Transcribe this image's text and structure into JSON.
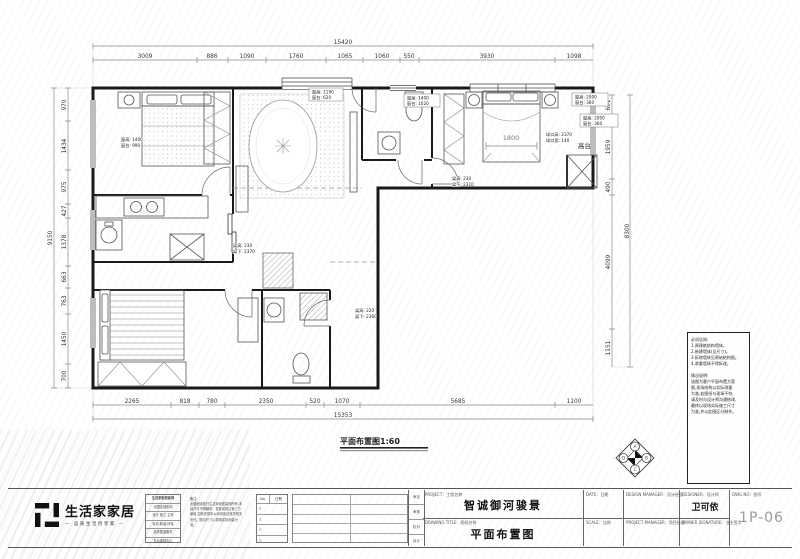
{
  "dims": {
    "top": {
      "overall": "15420",
      "segments": [
        "3009",
        "886",
        "1090",
        "1760",
        "1065",
        "1060",
        "550",
        "3930",
        "1098"
      ]
    },
    "left": {
      "overall": "9150",
      "segments": [
        "970",
        "1434",
        "975",
        "427",
        "1378",
        "663",
        "763",
        "1450",
        "700"
      ]
    },
    "right": {
      "overall": "8300",
      "segments": [
        "601",
        "1959",
        "490",
        "4099",
        "1151"
      ]
    },
    "bottom": {
      "overall": "15353",
      "segments": [
        "2265",
        "818",
        "780",
        "2350",
        "520",
        "1070",
        "5685",
        "1100"
      ]
    }
  },
  "labels": {
    "win_bedroom1": [
      "窗高: 1400",
      "窗台: 990"
    ],
    "win_entry": [
      "窗高: 1190",
      "窗台: 620"
    ],
    "win_bath": [
      "窗高: 1400",
      "窗台: 1020"
    ],
    "win_b3a": [
      "窗高: 2000",
      "窗台: 360"
    ],
    "win_b3b": [
      "窗高: 2000",
      "窗台: 360"
    ],
    "opening": [
      "垛口高: 2370",
      "垛口宽: 140"
    ],
    "beam_a": [
      "梁高: 230",
      "梁下: 2310"
    ],
    "beam_b": [
      "梁高: 230",
      "梁下: 2370"
    ],
    "beam_c": [
      "梁高: 220",
      "梁下: 2360"
    ],
    "bed_width": "1800",
    "platform": "高台",
    "plan_title": "平面布置图1:60"
  },
  "compass": {
    "n": "A",
    "e": "B",
    "s": "C",
    "w": "D"
  },
  "notes": {
    "text": "必须告知:\n1.原建筑结构墙体。\n2.新建墙体(见尺寸)。\n3.拆除墙体见原始结构图。\n4.承重墙体不得拆改。\n\n情况说明:\n该图为客户平面布置方案\n图,现场结构以实际测量\n为准,若图纸与现场不符,\n请及时与设计师沟通修改,\n最终以现场实际施工尺寸\n为准,并以此图区分制作。"
  },
  "footer": {
    "logo_name": "生活家家居",
    "logo_tagline": "— 品质生活创享家 —",
    "company_rows": [
      "生活家家居装饰",
      "全国连锁机构",
      "设计·施工·主材",
      "家具·软装·环保",
      "品质整装服务",
      "售后保障中心"
    ],
    "remark": "备注:\n此图纸版权归生活家家居装饰所有,未经许可不得翻印、复制或转让第三方使用,如有发现本公司将依法追究相关责任。图中尺寸以现场实际测量为准。",
    "rev_header_no": "No.",
    "rev_header_date": "日期",
    "rev_symbol": "△",
    "roles": [
      "审定",
      "审核",
      "校对",
      "设计"
    ],
    "project_label": "PROJECT：工程名称",
    "project_value": "智诚御河骏景",
    "drawing_label": "DRAWING TITLE：图纸名称",
    "drawing_value": "平面布置图",
    "date_label": "DATE：日期",
    "scale_label": "SCALE：比例",
    "dm_label": "DESIGN MANAGER：设计经理",
    "pm_label": "PROJECT MANAGER：项目经理",
    "designer_label": "DESIGNER：设计师",
    "designer_value": "卫可依",
    "owner_label": "OWNER SIGNATURE：业主签字",
    "dwg_label": "DWG NO：图号",
    "dwg_value": "1P-06"
  }
}
